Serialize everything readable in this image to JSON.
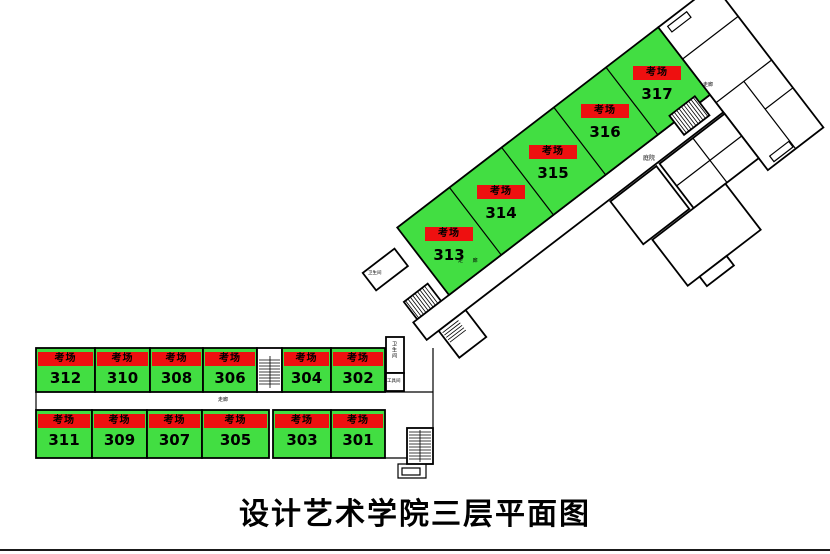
{
  "title": "设计艺术学院三层平面图",
  "colors": {
    "room_green": "#42DE42",
    "label_red": "#EE1010"
  },
  "wings": {
    "diagonal": {
      "rooms": [
        {
          "label": "考场",
          "number": "313"
        },
        {
          "label": "考场",
          "number": "314"
        },
        {
          "label": "考场",
          "number": "315"
        },
        {
          "label": "考场",
          "number": "316"
        },
        {
          "label": "考场",
          "number": "317"
        }
      ]
    },
    "top_row": {
      "rooms": [
        {
          "label": "考场",
          "number": "312"
        },
        {
          "label": "考场",
          "number": "310"
        },
        {
          "label": "考场",
          "number": "308"
        },
        {
          "label": "考场",
          "number": "306"
        },
        {
          "label": "考场",
          "number": "304"
        },
        {
          "label": "考场",
          "number": "302"
        }
      ]
    },
    "bottom_row": {
      "rooms": [
        {
          "label": "考场",
          "number": "311"
        },
        {
          "label": "考场",
          "number": "309"
        },
        {
          "label": "考场",
          "number": "307"
        },
        {
          "label": "考场",
          "number": "305"
        },
        {
          "label": "考场",
          "number": "303"
        },
        {
          "label": "考场",
          "number": "301"
        }
      ]
    }
  },
  "small_labels": {
    "corridor_lower": "走廊",
    "corridor_diag": "走 廊",
    "corridor_upper": "走廊",
    "courtyard": "庭院",
    "restroom_vertical": "卫生间",
    "toolroom": "工具间",
    "restroom_small": "卫生间"
  }
}
